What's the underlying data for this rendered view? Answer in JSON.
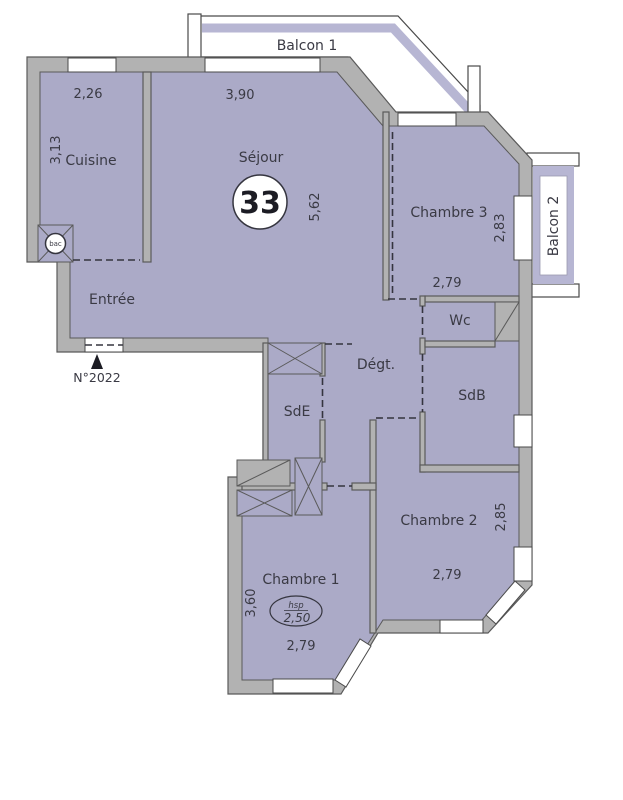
{
  "plan": {
    "unit_number": "33",
    "entrance_door_label": "N°2022",
    "balconies": {
      "balcon1": {
        "label": "Balcon 1"
      },
      "balcon2": {
        "label": "Balcon 2"
      }
    },
    "rooms": {
      "cuisine": {
        "label": "Cuisine",
        "dim_width": "2,26",
        "dim_depth": "3,13"
      },
      "sejour": {
        "label": "Séjour",
        "dim_width": "3,90",
        "dim_depth": "5,62"
      },
      "entree": {
        "label": "Entrée"
      },
      "chambre3": {
        "label": "Chambre 3",
        "dim_width": "2,79",
        "dim_depth": "2,83"
      },
      "wc": {
        "label": "Wc"
      },
      "sdb": {
        "label": "SdB"
      },
      "sde": {
        "label": "SdE"
      },
      "degt": {
        "label": "Dégt."
      },
      "chambre2": {
        "label": "Chambre 2",
        "dim_width": "2,79",
        "dim_depth": "2,85"
      },
      "chambre1": {
        "label": "Chambre 1",
        "dim_width": "2,79",
        "dim_depth": "3,60",
        "ceiling_label": "hsp",
        "ceiling_height": "2,50"
      }
    },
    "symbols": {
      "kitchen_sink": "bac"
    },
    "colors": {
      "room_fill": "#abaac7",
      "balcony_band": "#b7b6d3",
      "wall_gray": "#b2b2b2",
      "line_dark": "#35353f",
      "background": "#ffffff"
    }
  }
}
